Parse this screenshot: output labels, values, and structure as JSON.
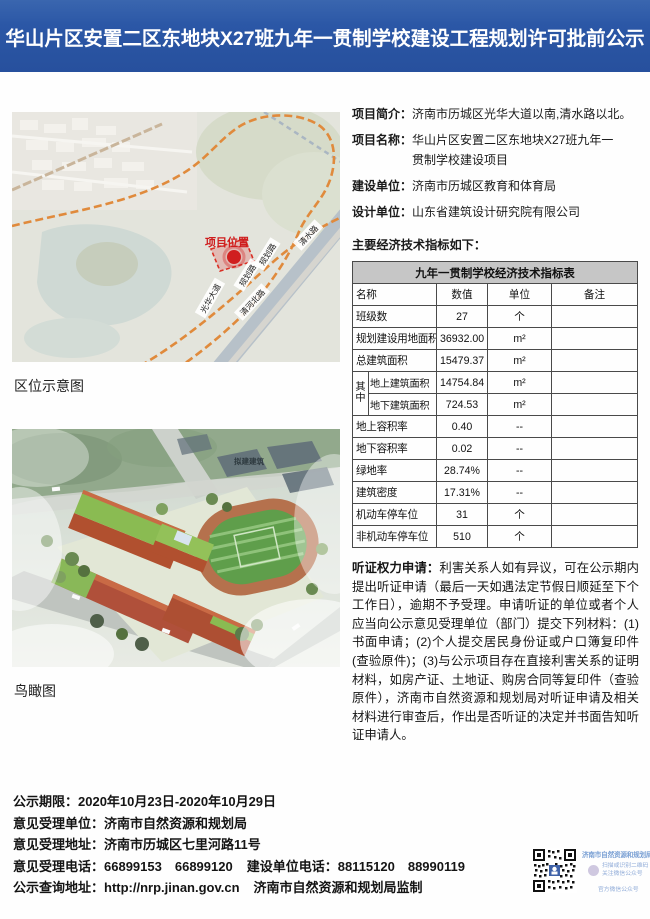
{
  "header": {
    "title": "华山片区安置二区东地块X27班九年一贯制学校建设工程规划许可批前公示",
    "accent_color": "#2b57a6"
  },
  "map": {
    "caption": "区位示意图",
    "site_label": "项目位置",
    "roads": [
      "清水路",
      "规划路",
      "规划路",
      "光华大道",
      "清河北路"
    ],
    "marker_color": "#d01f1f",
    "route_color": "#e08a3c"
  },
  "aerial": {
    "caption": "鸟瞰图",
    "label": "拟建建筑"
  },
  "info": {
    "rows": [
      {
        "label": "项目简介：",
        "value": "济南市历城区光华大道以南,清水路以北。",
        "value2": ""
      },
      {
        "label": "项目名称：",
        "value": "华山片区安置二区东地块X27班九年一",
        "value2": "贯制学校建设项目"
      },
      {
        "label": "建设单位：",
        "value": "济南市历城区教育和体育局",
        "value2": ""
      },
      {
        "label": "设计单位：",
        "value": "山东省建筑设计研究院有限公司",
        "value2": ""
      }
    ],
    "indicators_intro": "主要经济技术指标如下："
  },
  "table": {
    "title": "九年一贯制学校经济技术指标表",
    "headers": [
      "名称",
      "数值",
      "单位",
      "备注"
    ],
    "merge_label": "其中",
    "rows": [
      {
        "name": "班级数",
        "value": "27",
        "unit": "个",
        "note": ""
      },
      {
        "name": "规划建设用地面积",
        "value": "36932.00",
        "unit": "m²",
        "note": ""
      },
      {
        "name": "总建筑面积",
        "value": "15479.37",
        "unit": "m²",
        "note": ""
      },
      {
        "name": "地上建筑面积",
        "value": "14754.84",
        "unit": "m²",
        "note": ""
      },
      {
        "name": "地下建筑面积",
        "value": "724.53",
        "unit": "m²",
        "note": ""
      },
      {
        "name": "地上容积率",
        "value": "0.40",
        "unit": "--",
        "note": ""
      },
      {
        "name": "地下容积率",
        "value": "0.02",
        "unit": "--",
        "note": ""
      },
      {
        "name": "绿地率",
        "value": "28.74%",
        "unit": "--",
        "note": ""
      },
      {
        "name": "建筑密度",
        "value": "17.31%",
        "unit": "--",
        "note": ""
      },
      {
        "name": "机动车停车位",
        "value": "31",
        "unit": "个",
        "note": ""
      },
      {
        "name": "非机动车停车位",
        "value": "510",
        "unit": "个",
        "note": ""
      }
    ]
  },
  "hearing": {
    "label": "听证权力申请：",
    "text": "利害关系人如有异议，可在公示期内提出听证申请（最后一天如遇法定节假日顺延至下个工作日），逾期不予受理。申请听证的单位或者个人应当向公示意见受理单位（部门）提交下列材料：(1)书面申请；(2)个人提交居民身份证或户口簿复印件(查验原件)；(3)与公示项目存在直接利害关系的证明材料，如房产证、土地证、购房合同等复印件（查验原件），济南市自然资源和规划局对听证申请及相关材料进行审查后，作出是否听证的决定并书面告知听证申请人。"
  },
  "footer": {
    "lines": [
      {
        "label": "公示期限：",
        "value": "2020年10月23日-2020年10月29日"
      },
      {
        "label": "意见受理单位：",
        "value": "济南市自然资源和规划局"
      },
      {
        "label": "意见受理地址：",
        "value": "济南市历城区七里河路11号"
      },
      {
        "label": "意见受理电话：",
        "value": "66899153　66899120",
        "label2": "建设单位电话：",
        "value2": "88115120　88990119"
      },
      {
        "label": "公示查询地址：",
        "value": "http://nrp.jinan.gov.cn",
        "value2": "济南市自然资源和规划局监制"
      }
    ],
    "qr": {
      "title": "济南市自然资源和规划局",
      "line1": "扫描或识别二维码",
      "line2": "关注微信公众号",
      "line3": "官方微信公众号"
    }
  }
}
